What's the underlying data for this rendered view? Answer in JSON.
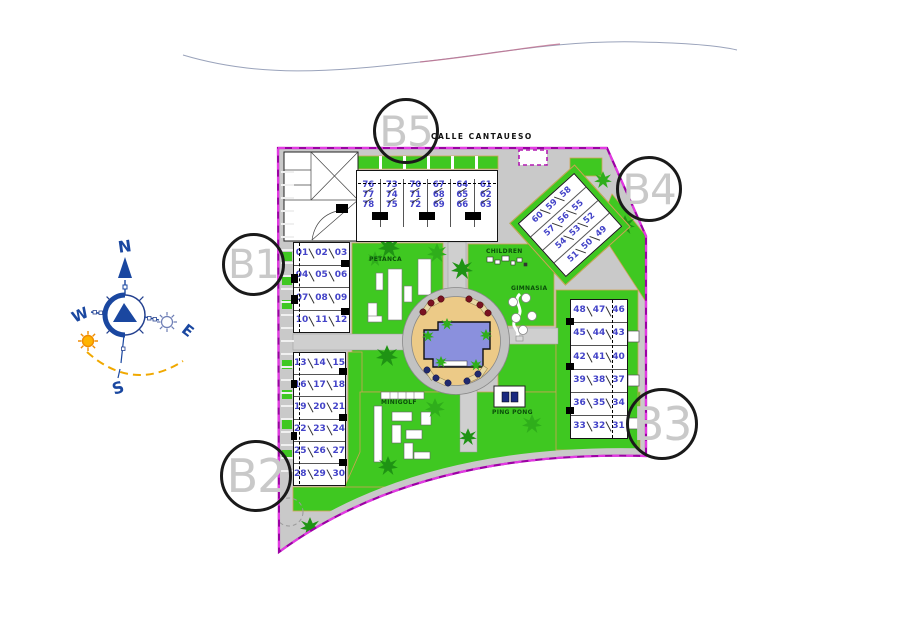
{
  "street": {
    "label": "CALLE CANTAUESO"
  },
  "compass": {
    "north": "N",
    "south": "S",
    "east": "E",
    "west": "W"
  },
  "markers": {
    "b1": "B1",
    "b2": "B2",
    "b3": "B3",
    "b4": "B4",
    "b5": "B5"
  },
  "amenities": {
    "petanca": "PETANCA",
    "children": "CHILDREN",
    "gimnasia": "GIMNASIA",
    "minigolf": "MINIGOLF",
    "ping_pong": "PING PONG"
  },
  "blocks": {
    "b5": {
      "columns": [
        [
          "76",
          "77",
          "78"
        ],
        [
          "73",
          "74",
          "75"
        ],
        [
          "70",
          "71",
          "72"
        ],
        [
          "67",
          "68",
          "69"
        ],
        [
          "64",
          "65",
          "66"
        ],
        [
          "61",
          "62",
          "63"
        ]
      ]
    },
    "b1": {
      "rows": [
        [
          "01",
          "02",
          "03"
        ],
        [
          "04",
          "05",
          "06"
        ],
        [
          "07",
          "08",
          "09"
        ],
        [
          "10",
          "11",
          "12"
        ]
      ]
    },
    "b2": {
      "rows": [
        [
          "13",
          "14",
          "15"
        ],
        [
          "16",
          "17",
          "18"
        ],
        [
          "19",
          "20",
          "21"
        ],
        [
          "22",
          "23",
          "24"
        ],
        [
          "25",
          "26",
          "27"
        ],
        [
          "28",
          "29",
          "30"
        ]
      ]
    },
    "b3": {
      "rows": [
        [
          "48",
          "47",
          "46"
        ],
        [
          "45",
          "44",
          "43"
        ],
        [
          "42",
          "41",
          "40"
        ],
        [
          "39",
          "38",
          "37"
        ],
        [
          "36",
          "35",
          "34"
        ],
        [
          "33",
          "32",
          "31"
        ]
      ]
    },
    "b4": {
      "rows": [
        [
          "60",
          "59",
          "58"
        ],
        [
          "57",
          "56",
          "55"
        ],
        [
          "54",
          "53",
          "52"
        ],
        [
          "51",
          "50",
          "49"
        ]
      ]
    }
  },
  "colors": {
    "green": "#3fc821",
    "dark-green": "#1f9314",
    "road": "#c9c9c9",
    "boundary": "#9c00a4",
    "boundary-dash": "#e23ae2",
    "unit-blue": "#4343c8",
    "pool-blue": "#8a90dd",
    "deck-tan": "#ecca87",
    "compass-blue": "#1a47a0",
    "sun-yellow": "#ffb400",
    "marker-grey": "#c9c9c9"
  }
}
